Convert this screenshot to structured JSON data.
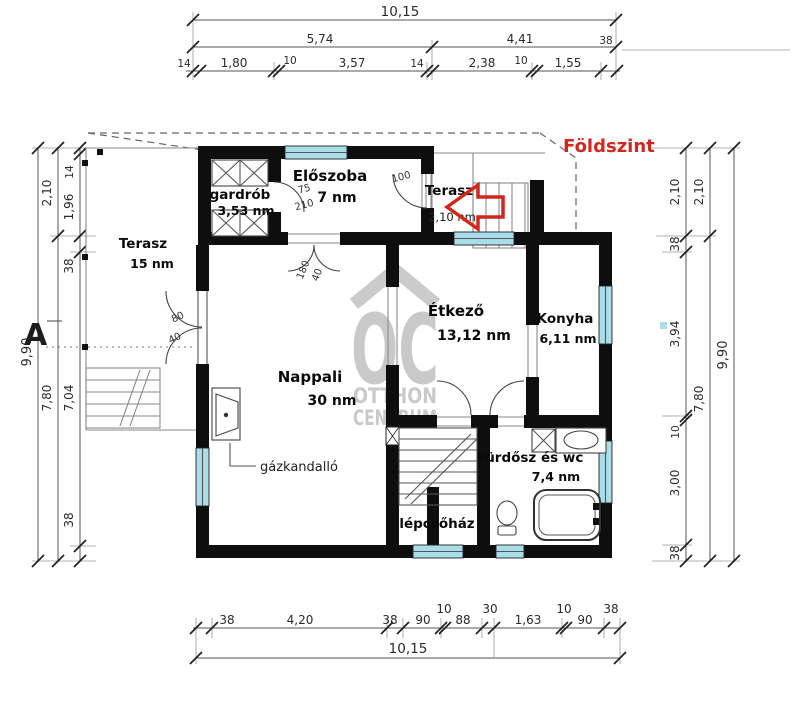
{
  "title": {
    "floor_label": "Földszint"
  },
  "rooms": {
    "terasz_nagy": {
      "name": "Terasz",
      "area": "15 nm"
    },
    "gardrob": {
      "name": "gardrób",
      "area": "3,53 nm"
    },
    "eloszoba": {
      "name": "Előszoba",
      "area": "7 nm"
    },
    "terasz_bejarat": {
      "name": "Terasz",
      "area": "2,10 nm"
    },
    "nappali": {
      "name": "Nappali",
      "area": "30 nm"
    },
    "etkezo": {
      "name": "Étkező",
      "area": "13,12 nm"
    },
    "konyha": {
      "name": "Konyha",
      "area": "6,11 nm"
    },
    "furdo": {
      "name": "Fürdősz és wc",
      "area": "7,4 nm"
    },
    "lepcsohaz": {
      "name": "lépcsőház"
    }
  },
  "annotations": {
    "gazkandallo": "gázkandalló",
    "section_marker": "A",
    "door_gardrob_width": "75",
    "door_gardrob_height": "210",
    "door_entry_width": "100",
    "door_nappali_width": "180",
    "door_nappali_height": "40",
    "door_terasz_width": "80",
    "door_terasz_height": "40"
  },
  "dimensions": {
    "top": {
      "overall": "10,15",
      "mid": [
        "5,74",
        "4,41",
        "38"
      ],
      "chain": [
        "14",
        "1,80",
        "10",
        "3,57",
        "14",
        "2,38",
        "10",
        "1,55"
      ]
    },
    "bottom": {
      "overall": "10,15",
      "chain": [
        "38",
        "4,20",
        "38",
        "90",
        "10",
        "88",
        "30",
        "1,63",
        "10",
        "90",
        "38"
      ]
    },
    "left": {
      "overall": "9,90",
      "mid": [
        "2,10",
        "7,80"
      ],
      "chain": [
        "14",
        "1,96",
        "38",
        "7,04",
        "38"
      ]
    },
    "right": {
      "overall": "9,90",
      "mid": [
        "2,10",
        "7,80"
      ],
      "chain": [
        "2,10",
        "38",
        "3,94",
        "10",
        "3,00",
        "38"
      ]
    }
  },
  "watermark": {
    "logo": "OC",
    "line1": "OTTHON",
    "line2": "CENTRUM"
  },
  "colors": {
    "wall": "#0e0e0e",
    "window": "#a8dde9",
    "accent": "#d3271e",
    "watermark": "#a9a9a9"
  }
}
